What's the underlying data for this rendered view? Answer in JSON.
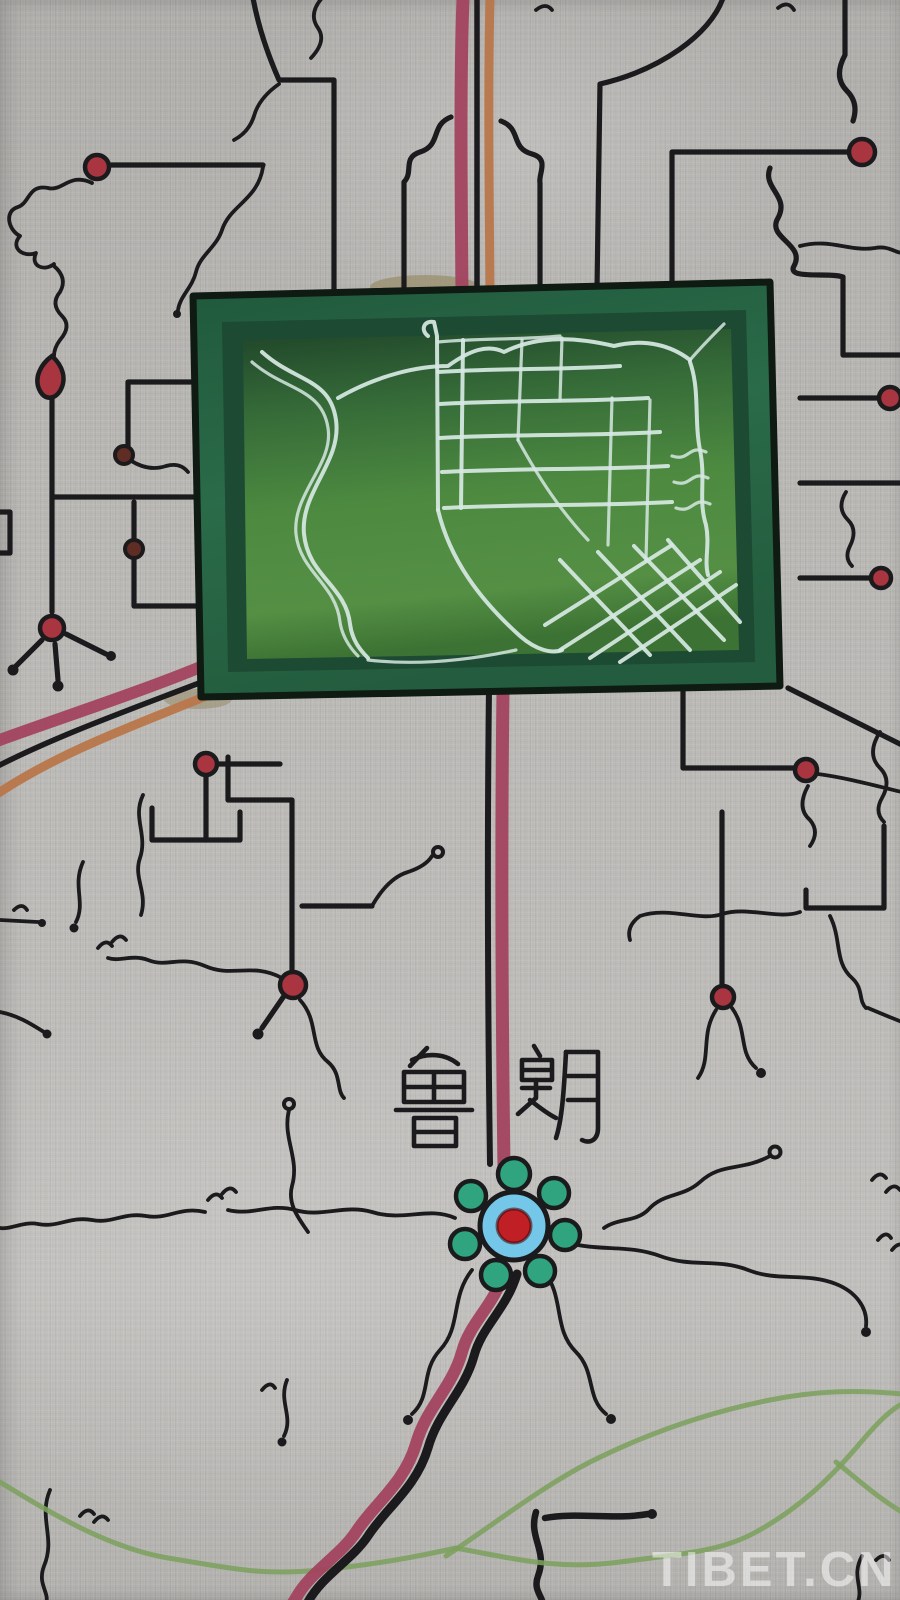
{
  "labels": {
    "place_name": "鲁朗",
    "place_char_left": "鲁",
    "place_char_right": "朗"
  },
  "watermark": {
    "text": "TIBET.CN"
  },
  "colors": {
    "canvas": "#b8b7b4",
    "ink": "#1b1b1d",
    "road_crimson": "#a2435f",
    "road_orange": "#b9764a",
    "node_red": "#a93540",
    "node_dark": "#5f2d24",
    "frame_green": "#2a6b49",
    "frame_bevel": "#1d4a33",
    "map_green_dark": "#1f4429",
    "map_green": "#4d8a40",
    "street_white": "#d6e8e2",
    "flower_blue": "#74c7e8",
    "flower_red": "#c01f26",
    "petal_teal": "#2fa47e",
    "border_green": "#7da15f",
    "watermark_white": "#ffffff",
    "patch_tan": "#9a8f6d"
  }
}
